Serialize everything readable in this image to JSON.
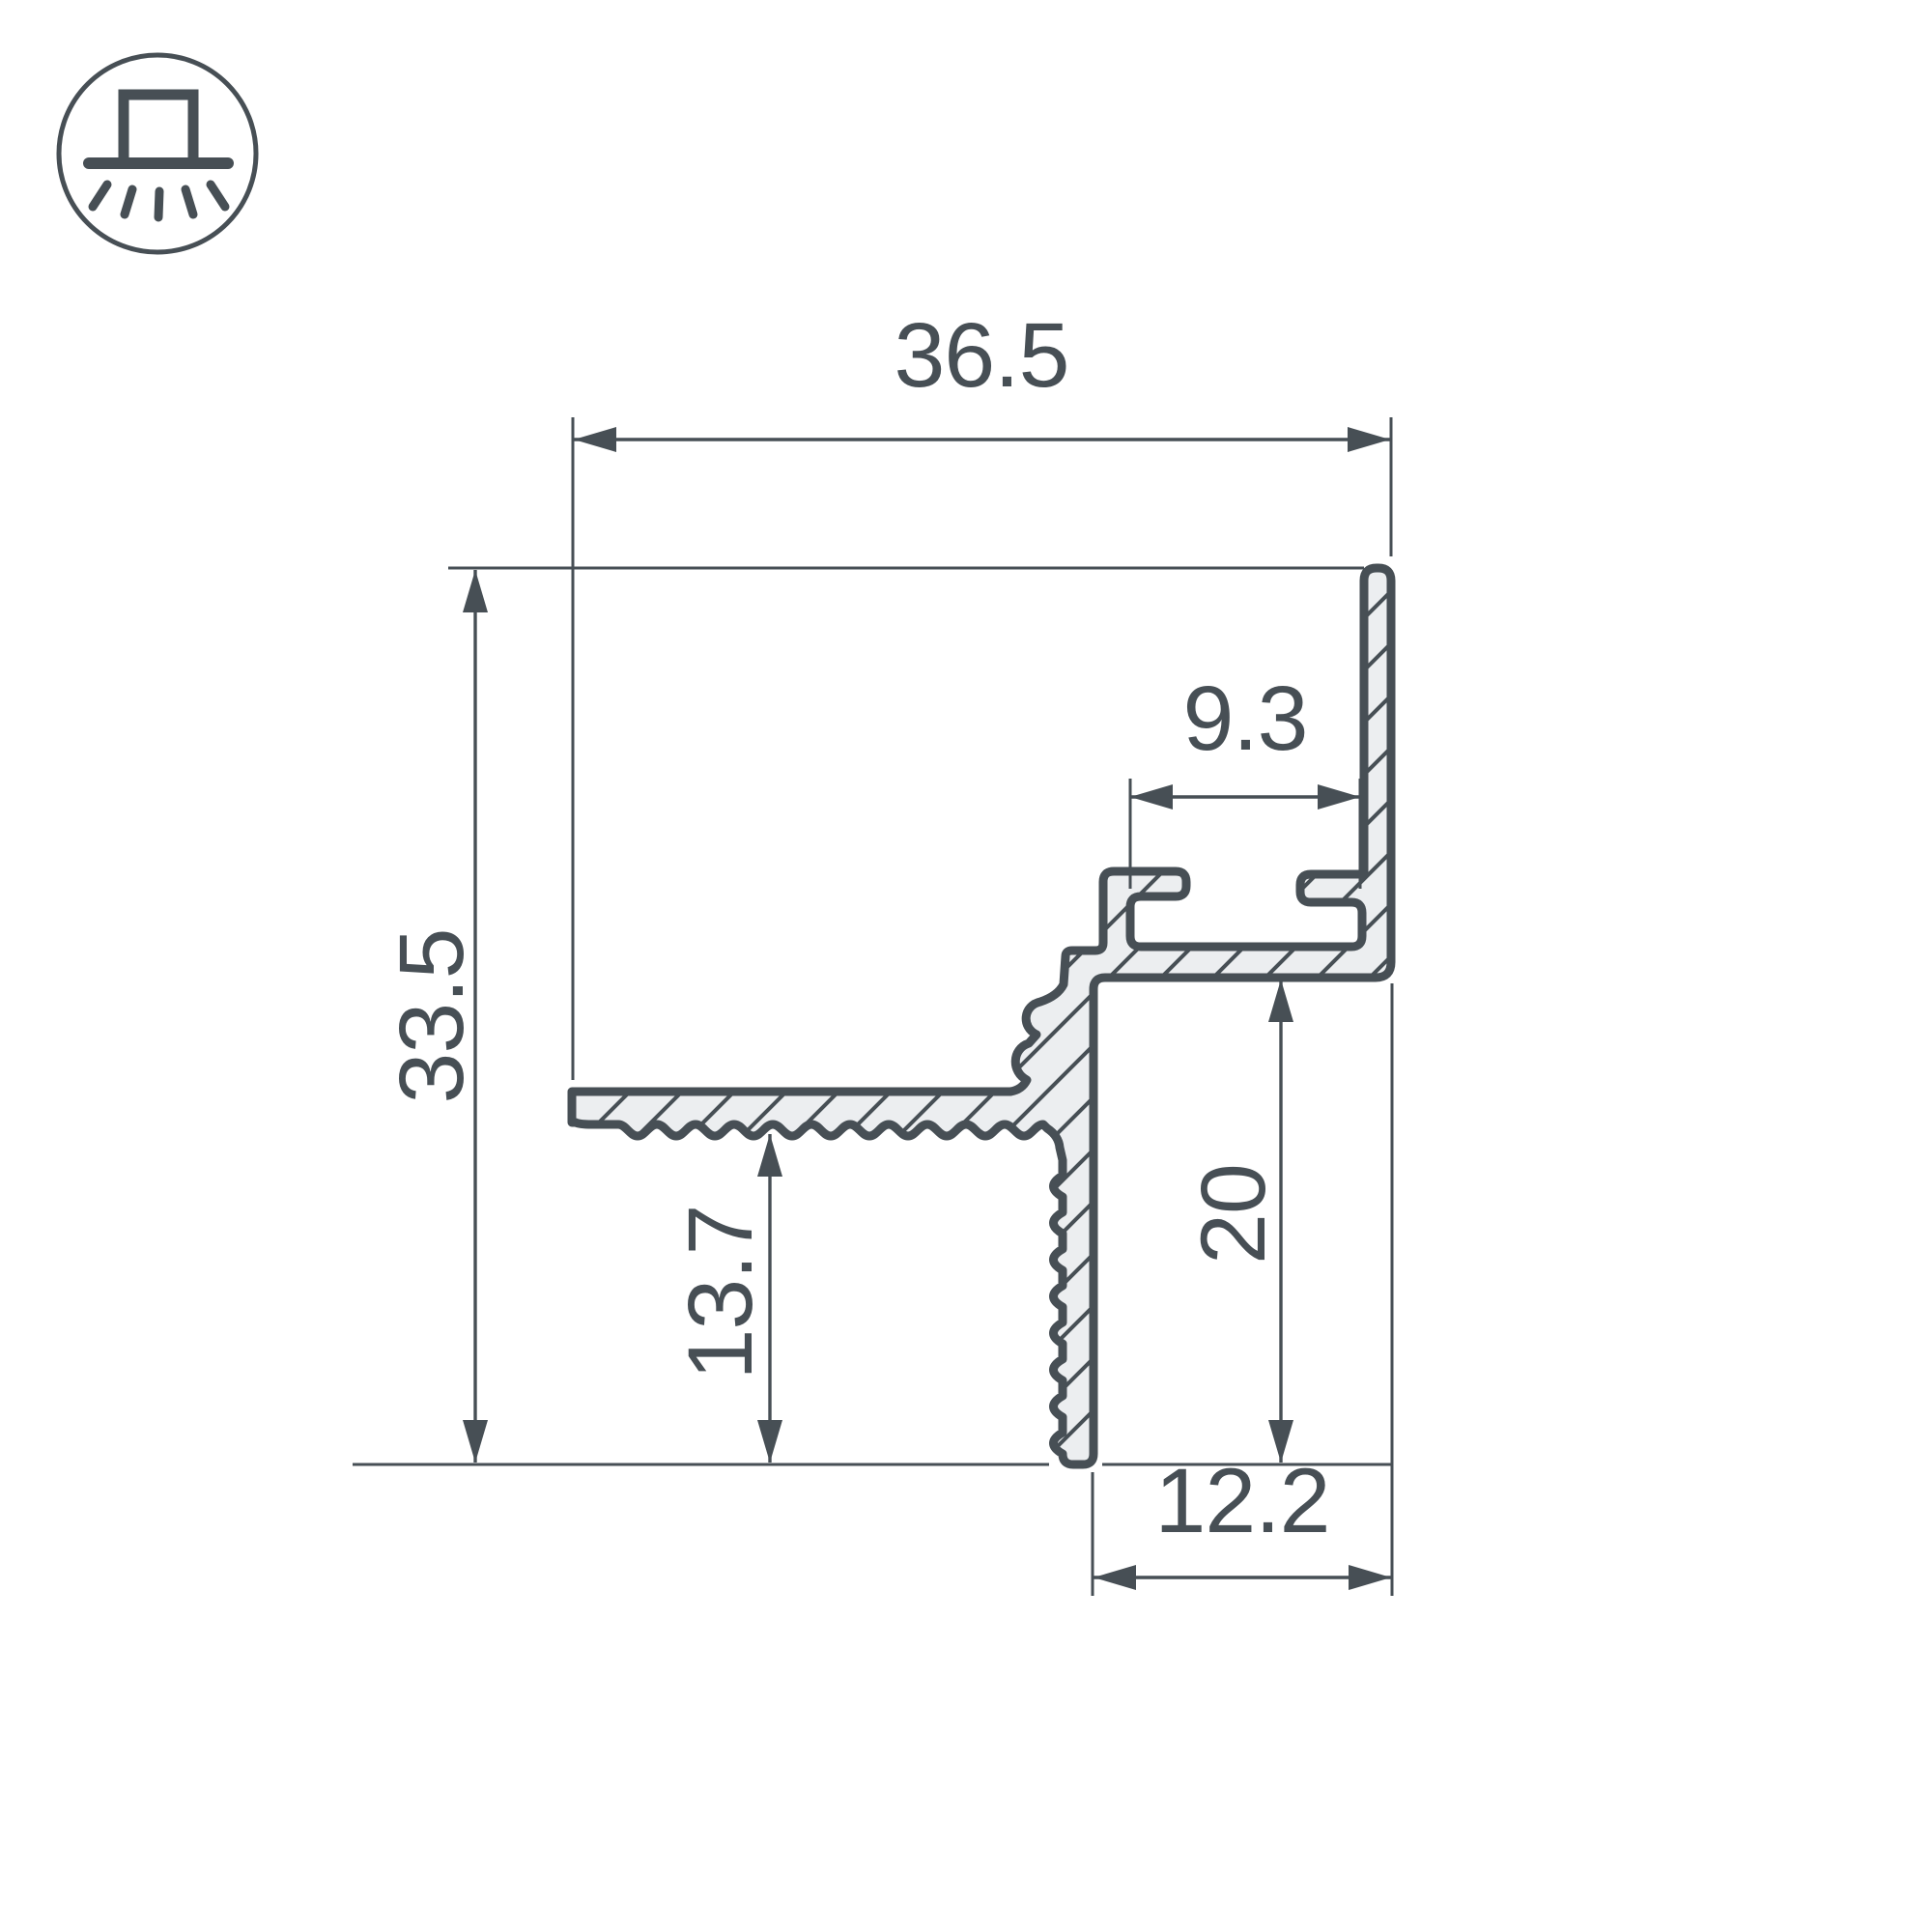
{
  "colors": {
    "background": "#ffffff",
    "ink": "#474f55",
    "profile_fill": "#eceef0"
  },
  "icon": {
    "name": "recessed-downlight-icon",
    "description": "surface fixture emitting light downward inside a circle"
  },
  "drawing": {
    "type": "profile-cross-section",
    "units": "mm",
    "dimensions": {
      "top_width": {
        "label": "36.5"
      },
      "left_height": {
        "label": "33.5"
      },
      "slot_width": {
        "label": "9.3"
      },
      "right_depth": {
        "label": "20"
      },
      "flange_drop": {
        "label": "13.7"
      },
      "bottom_width": {
        "label": "12.2"
      }
    }
  }
}
